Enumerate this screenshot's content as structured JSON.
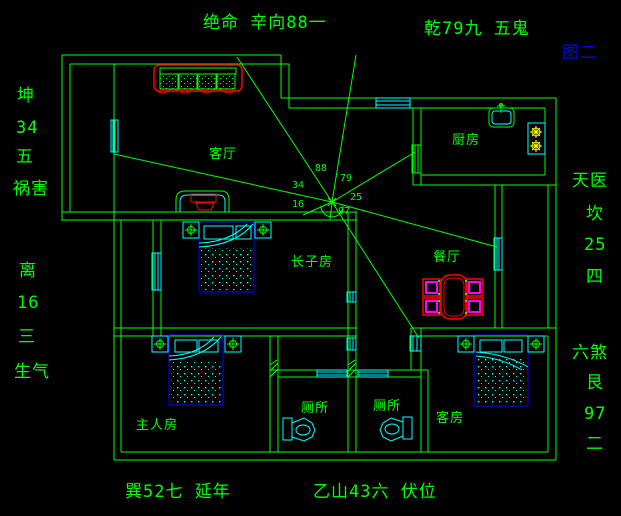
{
  "colors": {
    "background": "#000000",
    "wall_green": "#00ff00",
    "window_cyan": "#00ffff",
    "furniture_red": "#ff0000",
    "chair_magenta": "#ff00ff",
    "bed_blue": "#0000ff",
    "burner_yellow": "#ffff00",
    "figure_label_blue": "#0000ff"
  },
  "labels": {
    "top_left": "绝命 辛向88一",
    "top_right": "乾79九 五鬼",
    "figure": "图二",
    "left": [
      "坤",
      "34",
      "五",
      "祸害",
      "离",
      "16",
      "三",
      "生气"
    ],
    "right": [
      "天医",
      "坎",
      "25",
      "四",
      "六煞",
      "艮",
      "97",
      "二"
    ],
    "bottom_left": "巽52七  延年",
    "bottom_right": "乙山43六  伏位"
  },
  "rooms": {
    "living": "客厅",
    "kitchen": "厨房",
    "dining": "餐厅",
    "eldest_son": "长子房",
    "master": "主人房",
    "toilet": "厕所",
    "guest": "客房"
  },
  "compass": {
    "numbers": [
      "88",
      "79",
      "34",
      "25",
      "16",
      "97"
    ]
  }
}
